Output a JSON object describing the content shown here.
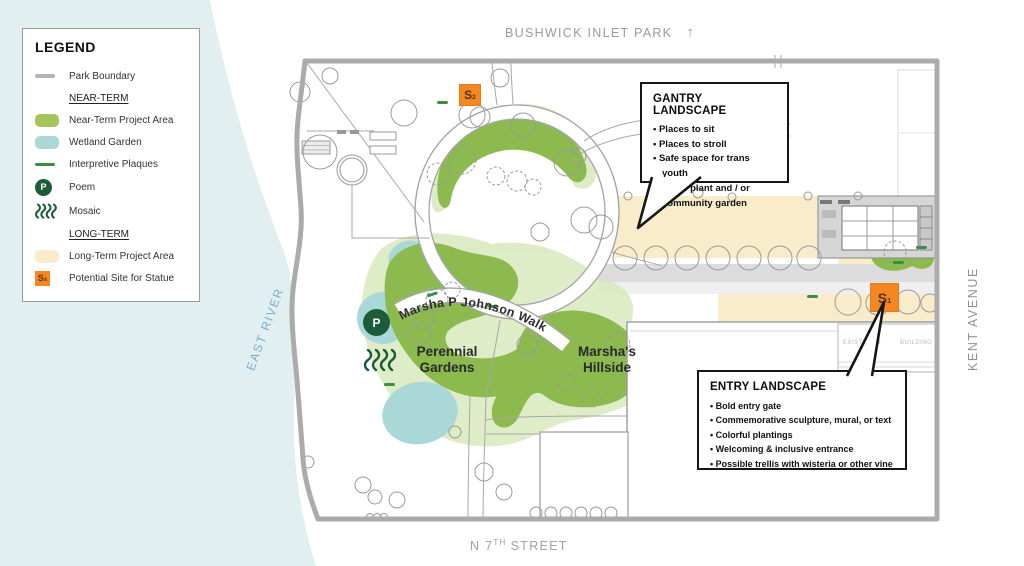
{
  "colors": {
    "near_term_green": "#8cba4f",
    "near_term_light": "#d7e7ba",
    "wetland_teal": "#a9d8d6",
    "long_term_tan": "#f8ecca",
    "statue_orange": "#f6861f",
    "poem_dark_green": "#1c5c3a",
    "plaque_green": "#3a8f47",
    "boundary_gray": "#ababab",
    "water_blue": "#e2eff1"
  },
  "legend": {
    "title": "LEGEND",
    "park_boundary": "Park Boundary",
    "near_term_heading": "NEAR-TERM",
    "near_term_area": "Near-Term Project Area",
    "wetland": "Wetland Garden",
    "plaques": "Interpretive Plaques",
    "poem": "Poem",
    "poem_letter": "P",
    "mosaic": "Mosaic",
    "long_term_heading": "LONG-TERM",
    "long_term_area": "Long-Term Project Area",
    "statue": "Potential Site for Statue",
    "statue_letter": "S",
    "statue_sub": "x"
  },
  "map": {
    "north_label": "BUSHWICK INLET PARK",
    "north_arrow": "↑",
    "east_river": "EAST RIVER",
    "kent_avenue": "KENT AVENUE",
    "street_prefix": "N 7",
    "street_sup": "TH",
    "street_rest": "STREET",
    "walk_label": "Marsha P Johnson Walk",
    "perennial_gardens": "Perennial Gardens",
    "marshas_hillside": "Marsha's Hillside",
    "existing_building_left": "EXISTING 3",
    "existing_building_right": "BUILDING",
    "poem_letter": "P",
    "statue_1_letter": "S",
    "statue_1_sub": "1",
    "statue_2_letter": "S",
    "statue_2_sub": "2"
  },
  "callouts": {
    "gantry": {
      "title": "GANTRY LANDSCAPE",
      "bullets": [
        "Places to sit",
        "Places to stroll",
        "Safe space for trans youth",
        "Native plant and / or community garden"
      ]
    },
    "entry": {
      "title": "ENTRY LANDSCAPE",
      "bullets": [
        "Bold entry gate",
        "Commemorative sculpture, mural, or text",
        "Colorful plantings",
        "Welcoming & inclusive entrance",
        "Possible trellis with wisteria or other vine"
      ]
    }
  }
}
